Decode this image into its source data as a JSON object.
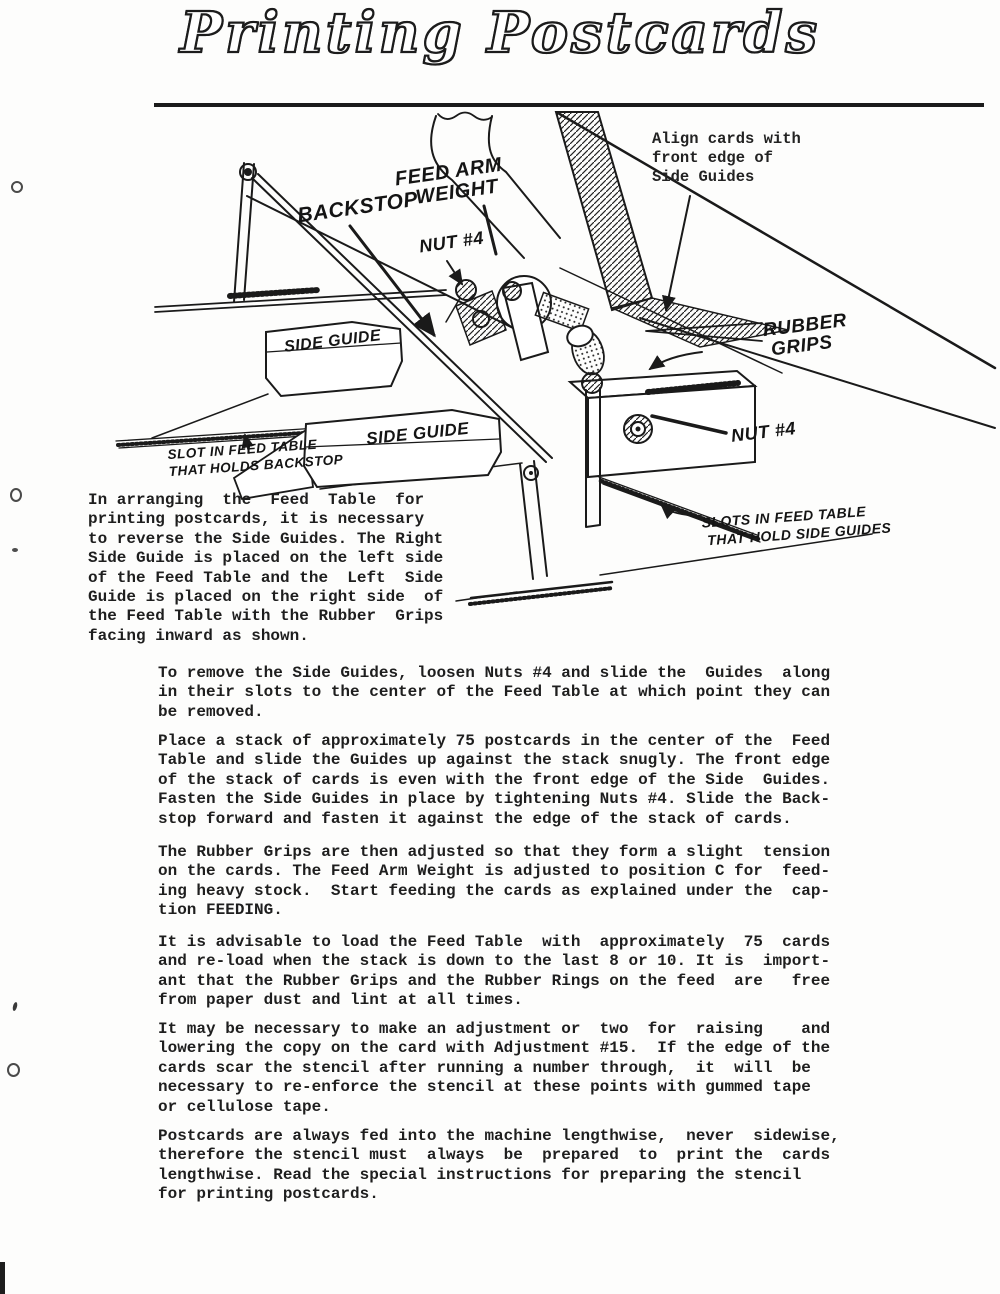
{
  "page": {
    "title": "Printing Postcards"
  },
  "diagram": {
    "align_note": "Align cards with\nfront edge of\nSide Guides",
    "labels": {
      "feed_arm_weight": "FEED ARM\n   WEIGHT",
      "backstop": "BACKSTOP",
      "nut4_left": "NUT #4",
      "side_guide_1": "SIDE GUIDE",
      "side_guide_2": "SIDE GUIDE",
      "rubber_grips": "RUBBER\n GRIPS",
      "nut4_right": "NUT #4",
      "slot_backstop": "SLOT IN FEED TABLE\nTHAT HOLDS BACKSTOP",
      "slots_side_guides": "SLOTS IN FEED TABLE\n THAT HOLD SIDE GUIDES"
    }
  },
  "intro": {
    "text": "In arranging  the  Feed  Table  for\nprinting postcards, it is necessary\nto reverse the Side Guides. The Right\nSide Guide is placed on the left side\nof the Feed Table and the  Left  Side\nGuide is placed on the right side  of\nthe Feed Table with the Rubber  Grips\nfacing inward as shown."
  },
  "paragraphs": [
    {
      "text": "To remove the Side Guides, loosen Nuts #4 and slide the  Guides  along\nin their slots to the center of the Feed Table at which point they can\nbe removed."
    },
    {
      "text": "Place a stack of approximately 75 postcards in the center of the  Feed\nTable and slide the Guides up against the stack snugly. The front edge\nof the stack of cards is even with the front edge of the Side  Guides.\nFasten the Side Guides in place by tightening Nuts #4. Slide the Back-\nstop forward and fasten it against the edge of the stack of cards."
    },
    {
      "text": "The Rubber Grips are then adjusted so that they form a slight  tension\non the cards. The Feed Arm Weight is adjusted to position C for  feed-\ning heavy stock.  Start feeding the cards as explained under the  cap-\ntion FEEDING."
    },
    {
      "text": "It is advisable to load the Feed Table  with  approximately  75  cards\nand re-load when the stack is down to the last 8 or 10. It is  import-\nant that the Rubber Grips and the Rubber Rings on the feed  are   free\nfrom paper dust and lint at all times."
    },
    {
      "text": "It may be necessary to make an adjustment or  two  for  raising    and\nlowering the copy on the card with Adjustment #15.  If the edge of the\ncards scar the stencil after running a number through,  it  will  be\nnecessary to re-enforce the stencil at these points with gummed tape\nor cellulose tape."
    },
    {
      "text": "Postcards are always fed into the machine lengthwise,  never  sidewise,\ntherefore the stencil must  always  be  prepared  to  print the  cards\nlengthwise. Read the special instructions for preparing the stencil\nfor printing postcards."
    }
  ]
}
